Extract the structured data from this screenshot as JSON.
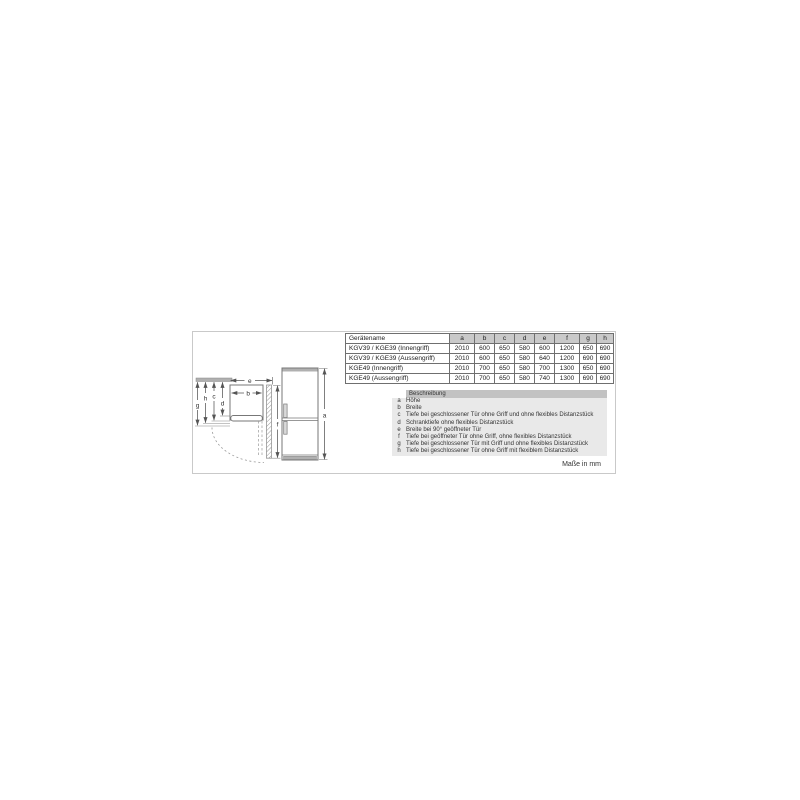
{
  "panel": {
    "units_note": "Maße in mm"
  },
  "dimension_table": {
    "name_header": "Gerätename",
    "dim_headers": [
      "a",
      "b",
      "c",
      "d",
      "e",
      "f",
      "g",
      "h"
    ],
    "rows": [
      {
        "name": "KGV39 / KGE39 (Innengriff)",
        "values": [
          "2010",
          "600",
          "650",
          "580",
          "600",
          "1200",
          "650",
          "690"
        ]
      },
      {
        "name": "KGV39 / KGE39 (Aussengriff)",
        "values": [
          "2010",
          "600",
          "650",
          "580",
          "640",
          "1200",
          "690",
          "690"
        ]
      },
      {
        "name": "KGE49 (Innengriff)",
        "values": [
          "2010",
          "700",
          "650",
          "580",
          "700",
          "1300",
          "650",
          "690"
        ]
      },
      {
        "name": "KGE49 (Aussengriff)",
        "values": [
          "2010",
          "700",
          "650",
          "580",
          "740",
          "1300",
          "690",
          "690"
        ]
      }
    ]
  },
  "legend": {
    "header": "Beschreibung",
    "items": [
      {
        "key": "a",
        "text": "Höhe"
      },
      {
        "key": "b",
        "text": "Breite"
      },
      {
        "key": "c",
        "text": "Tiefe bei geschlossener Tür ohne Griff und ohne flexibles Distanzstück"
      },
      {
        "key": "d",
        "text": "Schranktiefe ohne flexibles Distanzstück"
      },
      {
        "key": "e",
        "text": "Breite bei 90° geöffneter Tür"
      },
      {
        "key": "f",
        "text": "Tiefe bei geöffneter Tür ohne Griff, ohne flexibles Distanzstück"
      },
      {
        "key": "g",
        "text": "Tiefe bei geschlossener Tür mit Griff und ohne flexibles Distanzstück"
      },
      {
        "key": "h",
        "text": "Tiefe bei geschlossener Tür ohne Griff mit flexiblem Distanzstück"
      }
    ]
  },
  "diagram": {
    "labels": {
      "a": "a",
      "b": "b",
      "c": "c",
      "d": "d",
      "e": "e",
      "f": "f",
      "g": "g",
      "h": "h"
    }
  },
  "colors": {
    "frame_border": "#c9c9c9",
    "table_border": "#6f6f6f",
    "table_header_fill": "#c9c9c9",
    "legend_bg": "#e9e9e9",
    "legend_header_fill": "#c2c2c2",
    "drawing_line": "#777777",
    "drawing_fill_gray": "#b0b0b0",
    "text": "#222222"
  }
}
